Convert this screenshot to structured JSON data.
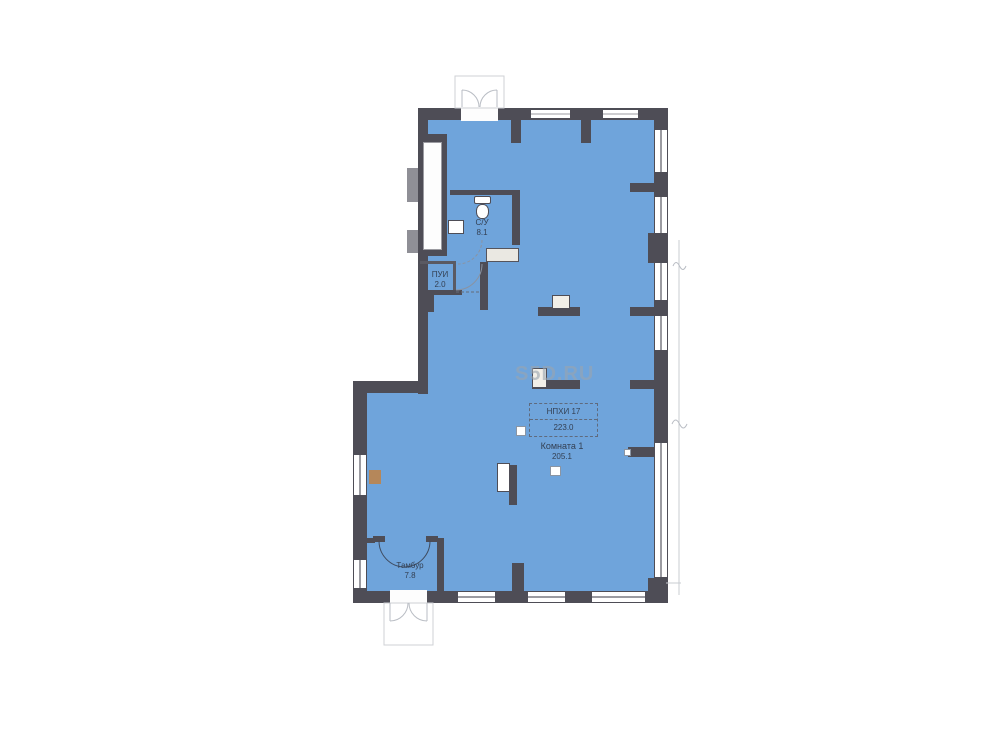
{
  "watermark": "S5D.RU",
  "labels": {
    "wc": {
      "name": "С/У",
      "area": "8.1"
    },
    "pui": {
      "name": "ПУИ",
      "area": "2.0"
    },
    "unit_box": {
      "line1": "НПХИ 17",
      "line2": "223.0"
    },
    "room": {
      "name": "Комната 1",
      "area": "205.1"
    },
    "tambour": {
      "name": "Тамбур",
      "area": "7.8"
    }
  },
  "colors": {
    "floor": "#6FA4DB",
    "wall": "#4E4D56",
    "frame": "#9B9BA1",
    "text": "#333F52",
    "watermark": "#9AA5B0",
    "counter": "#EAE8E2",
    "accent": "#B5875A",
    "light": "#C9CCD2"
  }
}
